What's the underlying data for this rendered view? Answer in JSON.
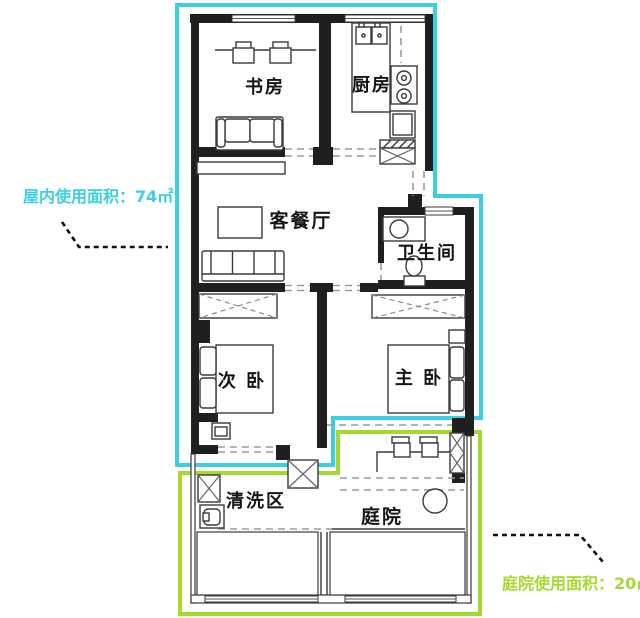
{
  "page": {
    "background": "#ffffff",
    "kind": "apartment floor plan"
  },
  "colors": {
    "cyan": "#3ccfe2",
    "green": "#a6d92f",
    "wall": "#1f1f1f",
    "line": "#3a3a3a",
    "dash": "#9a9a9a",
    "leader": "#111111"
  },
  "rooms": {
    "study": {
      "label": "书房"
    },
    "kitchen": {
      "label": "厨房"
    },
    "living_dining": {
      "label": "客餐厅"
    },
    "bathroom": {
      "label": "卫生间"
    },
    "second_bedroom": {
      "label": "次 卧"
    },
    "master_bedroom": {
      "label": "主 卧"
    },
    "washing_area": {
      "label": "清洗区"
    },
    "courtyard": {
      "label": "庭院"
    }
  },
  "annotations": {
    "indoor_area": {
      "text": "屋内使用面积：74㎡"
    },
    "courtyard_area": {
      "text": "庭院使用面积：20㎡"
    }
  }
}
